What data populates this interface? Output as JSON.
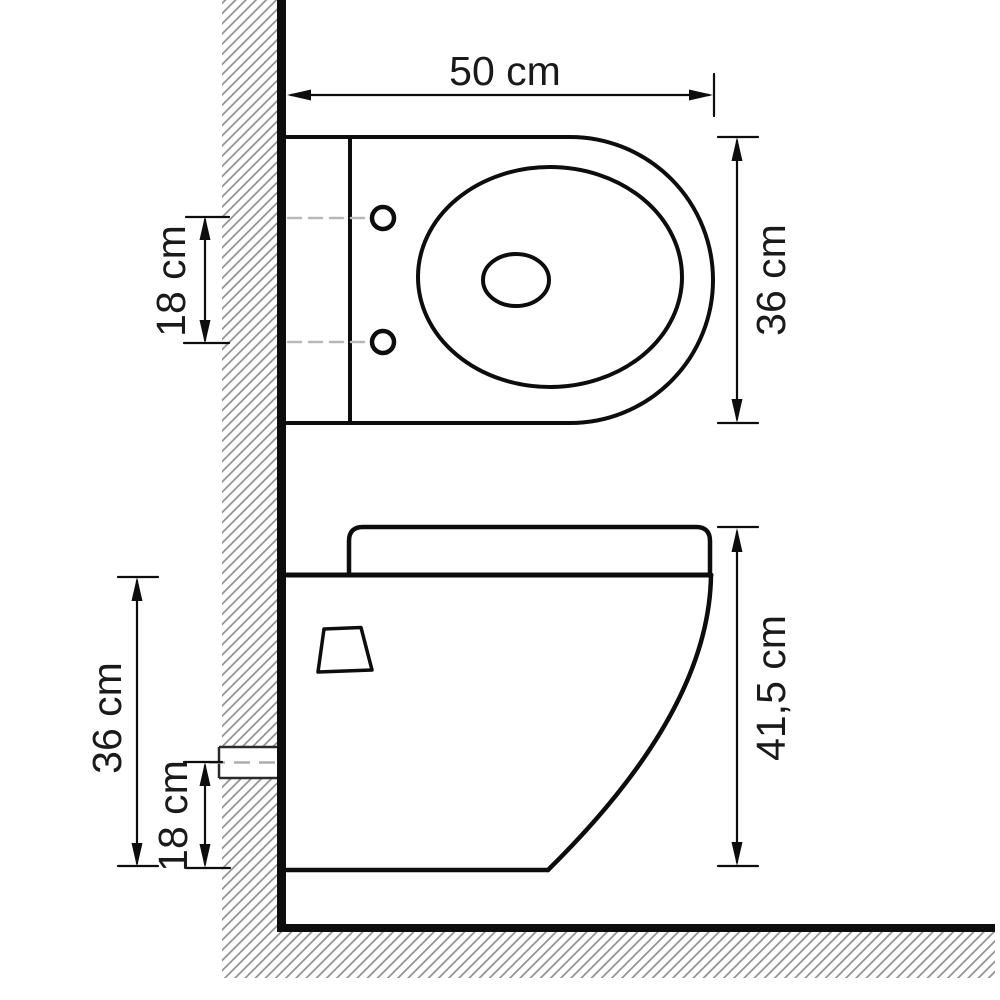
{
  "title": "Wall-hung toilet dimension drawing",
  "colors": {
    "background": "#ffffff",
    "line": "#0d0d0d",
    "hatch": "#8f8f8f",
    "dashed_centerline": "#b8b8b8",
    "pipe_outline": "#2a2a2a",
    "text": "#1a1a1a"
  },
  "top_view": {
    "name": "plan view of toilet",
    "width_label": "50 cm",
    "depth_label": "36 cm",
    "mount_hole_spacing_label": "18 cm",
    "mount_hole_count": 2
  },
  "side_view": {
    "name": "side elevation of wall-hung toilet",
    "total_height_label": "41,5 cm",
    "rim_height_label": "36 cm",
    "outlet_pipe_height_label": "18 cm"
  },
  "labels": {
    "top_width": "50 cm",
    "top_hole_spacing": "18 cm",
    "top_depth": "36 cm",
    "side_rim_height": "36 cm",
    "side_outlet_height": "18 cm",
    "side_total_height": "41,5 cm"
  }
}
